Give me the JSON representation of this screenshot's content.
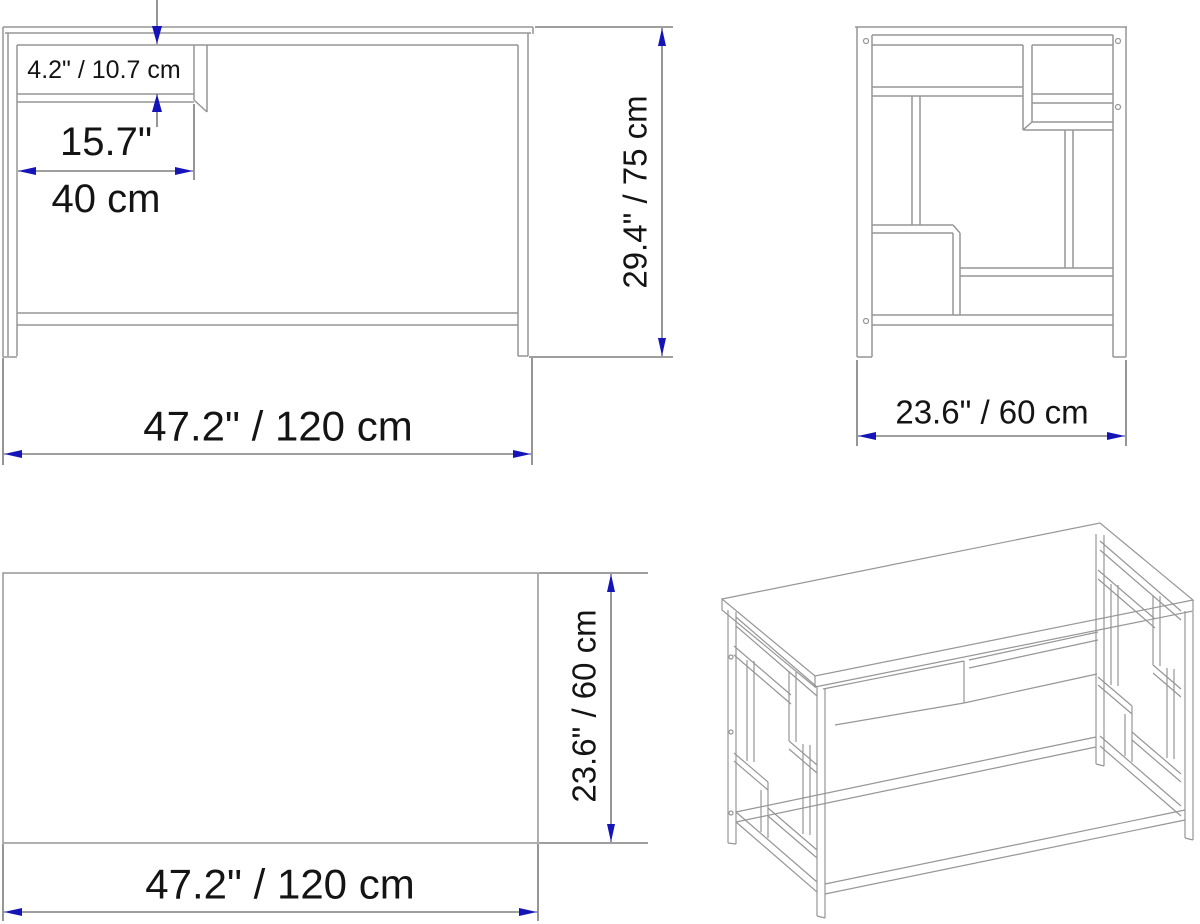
{
  "colors": {
    "background": "#ffffff",
    "drawing_line": "#969696",
    "dimension_line": "#3f3f3f",
    "arrow": "#1414b8",
    "text": "#141414"
  },
  "front_view": {
    "shelf_gap_label": "4.2\" / 10.7 cm",
    "shelf_width_inches_label": "15.7\"",
    "shelf_width_cm_label": "40 cm",
    "height_label": "29.4\" / 75 cm",
    "width_label": "47.2\" / 120 cm"
  },
  "side_view": {
    "depth_label": "23.6\" / 60 cm"
  },
  "top_view": {
    "depth_label": "23.6\" / 60 cm",
    "width_label": "47.2\" / 120 cm"
  }
}
